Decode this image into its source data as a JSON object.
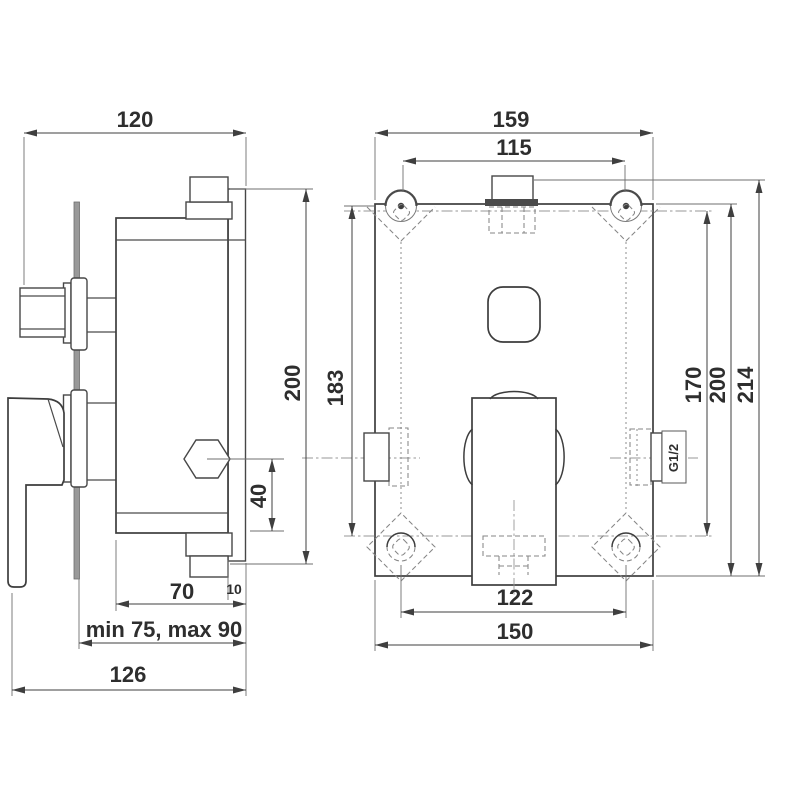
{
  "side_view": {
    "dims": {
      "width_top": "120",
      "height": "200",
      "outlet_offset": "40",
      "body_depth": "70",
      "plate_thickness": "10",
      "install_depth_range": "min 75, max 90",
      "total_depth": "126"
    }
  },
  "front_view": {
    "dims": {
      "overall_width": "159",
      "screw_spacing_top": "115",
      "height_left": "183",
      "screw_spacing_vertical": "170",
      "box_height": "200",
      "overall_height": "214",
      "screw_spacing_bottom": "122",
      "box_width_bottom": "150"
    },
    "thread_label": "G1/2"
  }
}
